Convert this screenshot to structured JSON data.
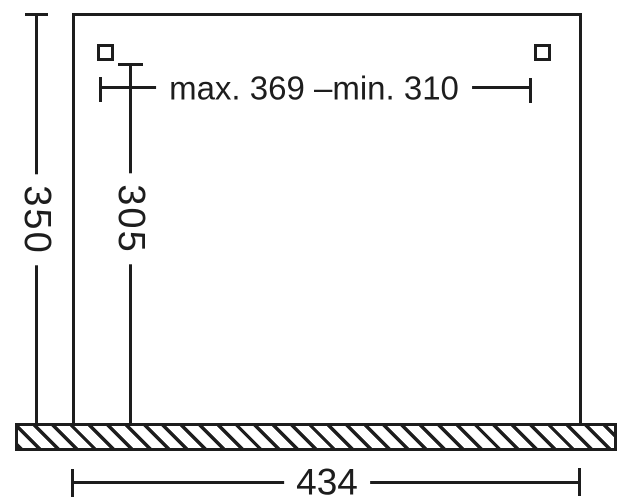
{
  "diagram": {
    "background_color": "#ffffff",
    "line_color": "#1d1d1d",
    "parts": {
      "appliance_outline": "open-bottom rectangle",
      "mounting_holes": "two small squares",
      "base_section": "hatched bar"
    },
    "dimensions": {
      "top_span_label": "max. 369 –min. 310",
      "left_height_label": "350",
      "inner_height_label": "305",
      "base_width_label": "434"
    }
  }
}
